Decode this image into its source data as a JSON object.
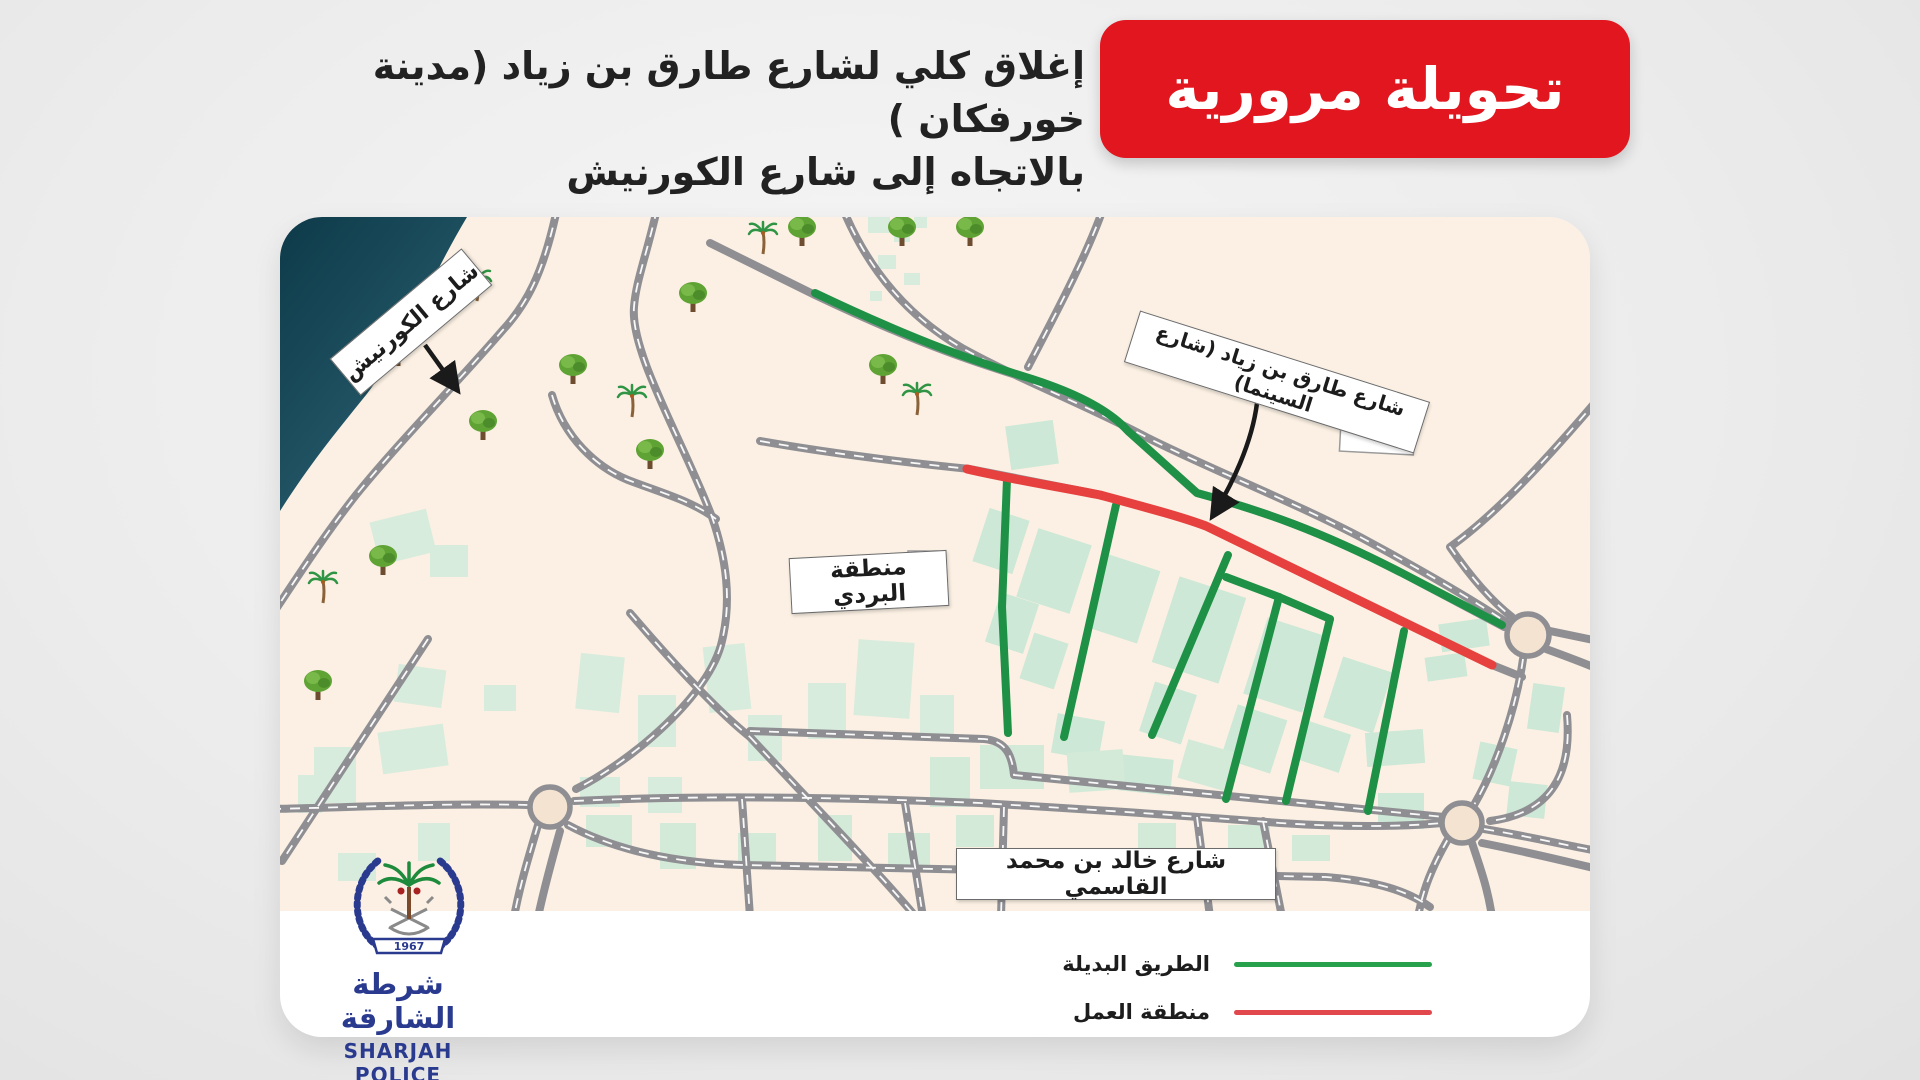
{
  "header": {
    "closure_line1": "إغلاق كلي لشارع طارق بن زياد (مدينة خورفكان )",
    "closure_line2": "بالاتجاه إلى شارع الكورنيش",
    "banner_label": "تحويلة مرورية",
    "banner_color": "#e2161e"
  },
  "map": {
    "street_labels": {
      "corniche": "شارع الكورنيش",
      "tariq_bin_ziyad": "شارع طارق بن زياد (شارع السينما)",
      "bardi_area": "منطقة البردي",
      "qasimi": "شارع خالد بن محمد القاسمي"
    },
    "route_colors": {
      "alternative": "#1f9147",
      "closed": "#e6403f"
    },
    "water_color": "#11404f",
    "road_color": "#8f8f93",
    "background_color": "#fbf0e3",
    "trees": [
      {
        "t": "palm",
        "x": 483,
        "y": 15
      },
      {
        "t": "tree",
        "x": 522,
        "y": 8
      },
      {
        "t": "tree",
        "x": 622,
        "y": 8
      },
      {
        "t": "tree",
        "x": 690,
        "y": 8
      },
      {
        "t": "palm",
        "x": 197,
        "y": 62
      },
      {
        "t": "tree",
        "x": 413,
        "y": 74
      },
      {
        "t": "tree",
        "x": 118,
        "y": 128
      },
      {
        "t": "tree",
        "x": 293,
        "y": 146
      },
      {
        "t": "tree",
        "x": 603,
        "y": 146
      },
      {
        "t": "palm",
        "x": 352,
        "y": 178
      },
      {
        "t": "palm",
        "x": 637,
        "y": 176
      },
      {
        "t": "tree",
        "x": 370,
        "y": 231
      },
      {
        "t": "tree",
        "x": 203,
        "y": 202
      },
      {
        "t": "tree",
        "x": 103,
        "y": 337
      },
      {
        "t": "palm",
        "x": 43,
        "y": 364
      },
      {
        "t": "tree",
        "x": 38,
        "y": 462
      }
    ]
  },
  "legend": {
    "items": [
      {
        "label": "الطريق البديلة",
        "color": "#27a14c"
      },
      {
        "label": "منطقة العمل",
        "color": "#e0484d"
      }
    ]
  },
  "logo": {
    "arabic_name": "شرطة الشارقة",
    "english_name": "SHARJAH POLICE",
    "year": "1967"
  }
}
